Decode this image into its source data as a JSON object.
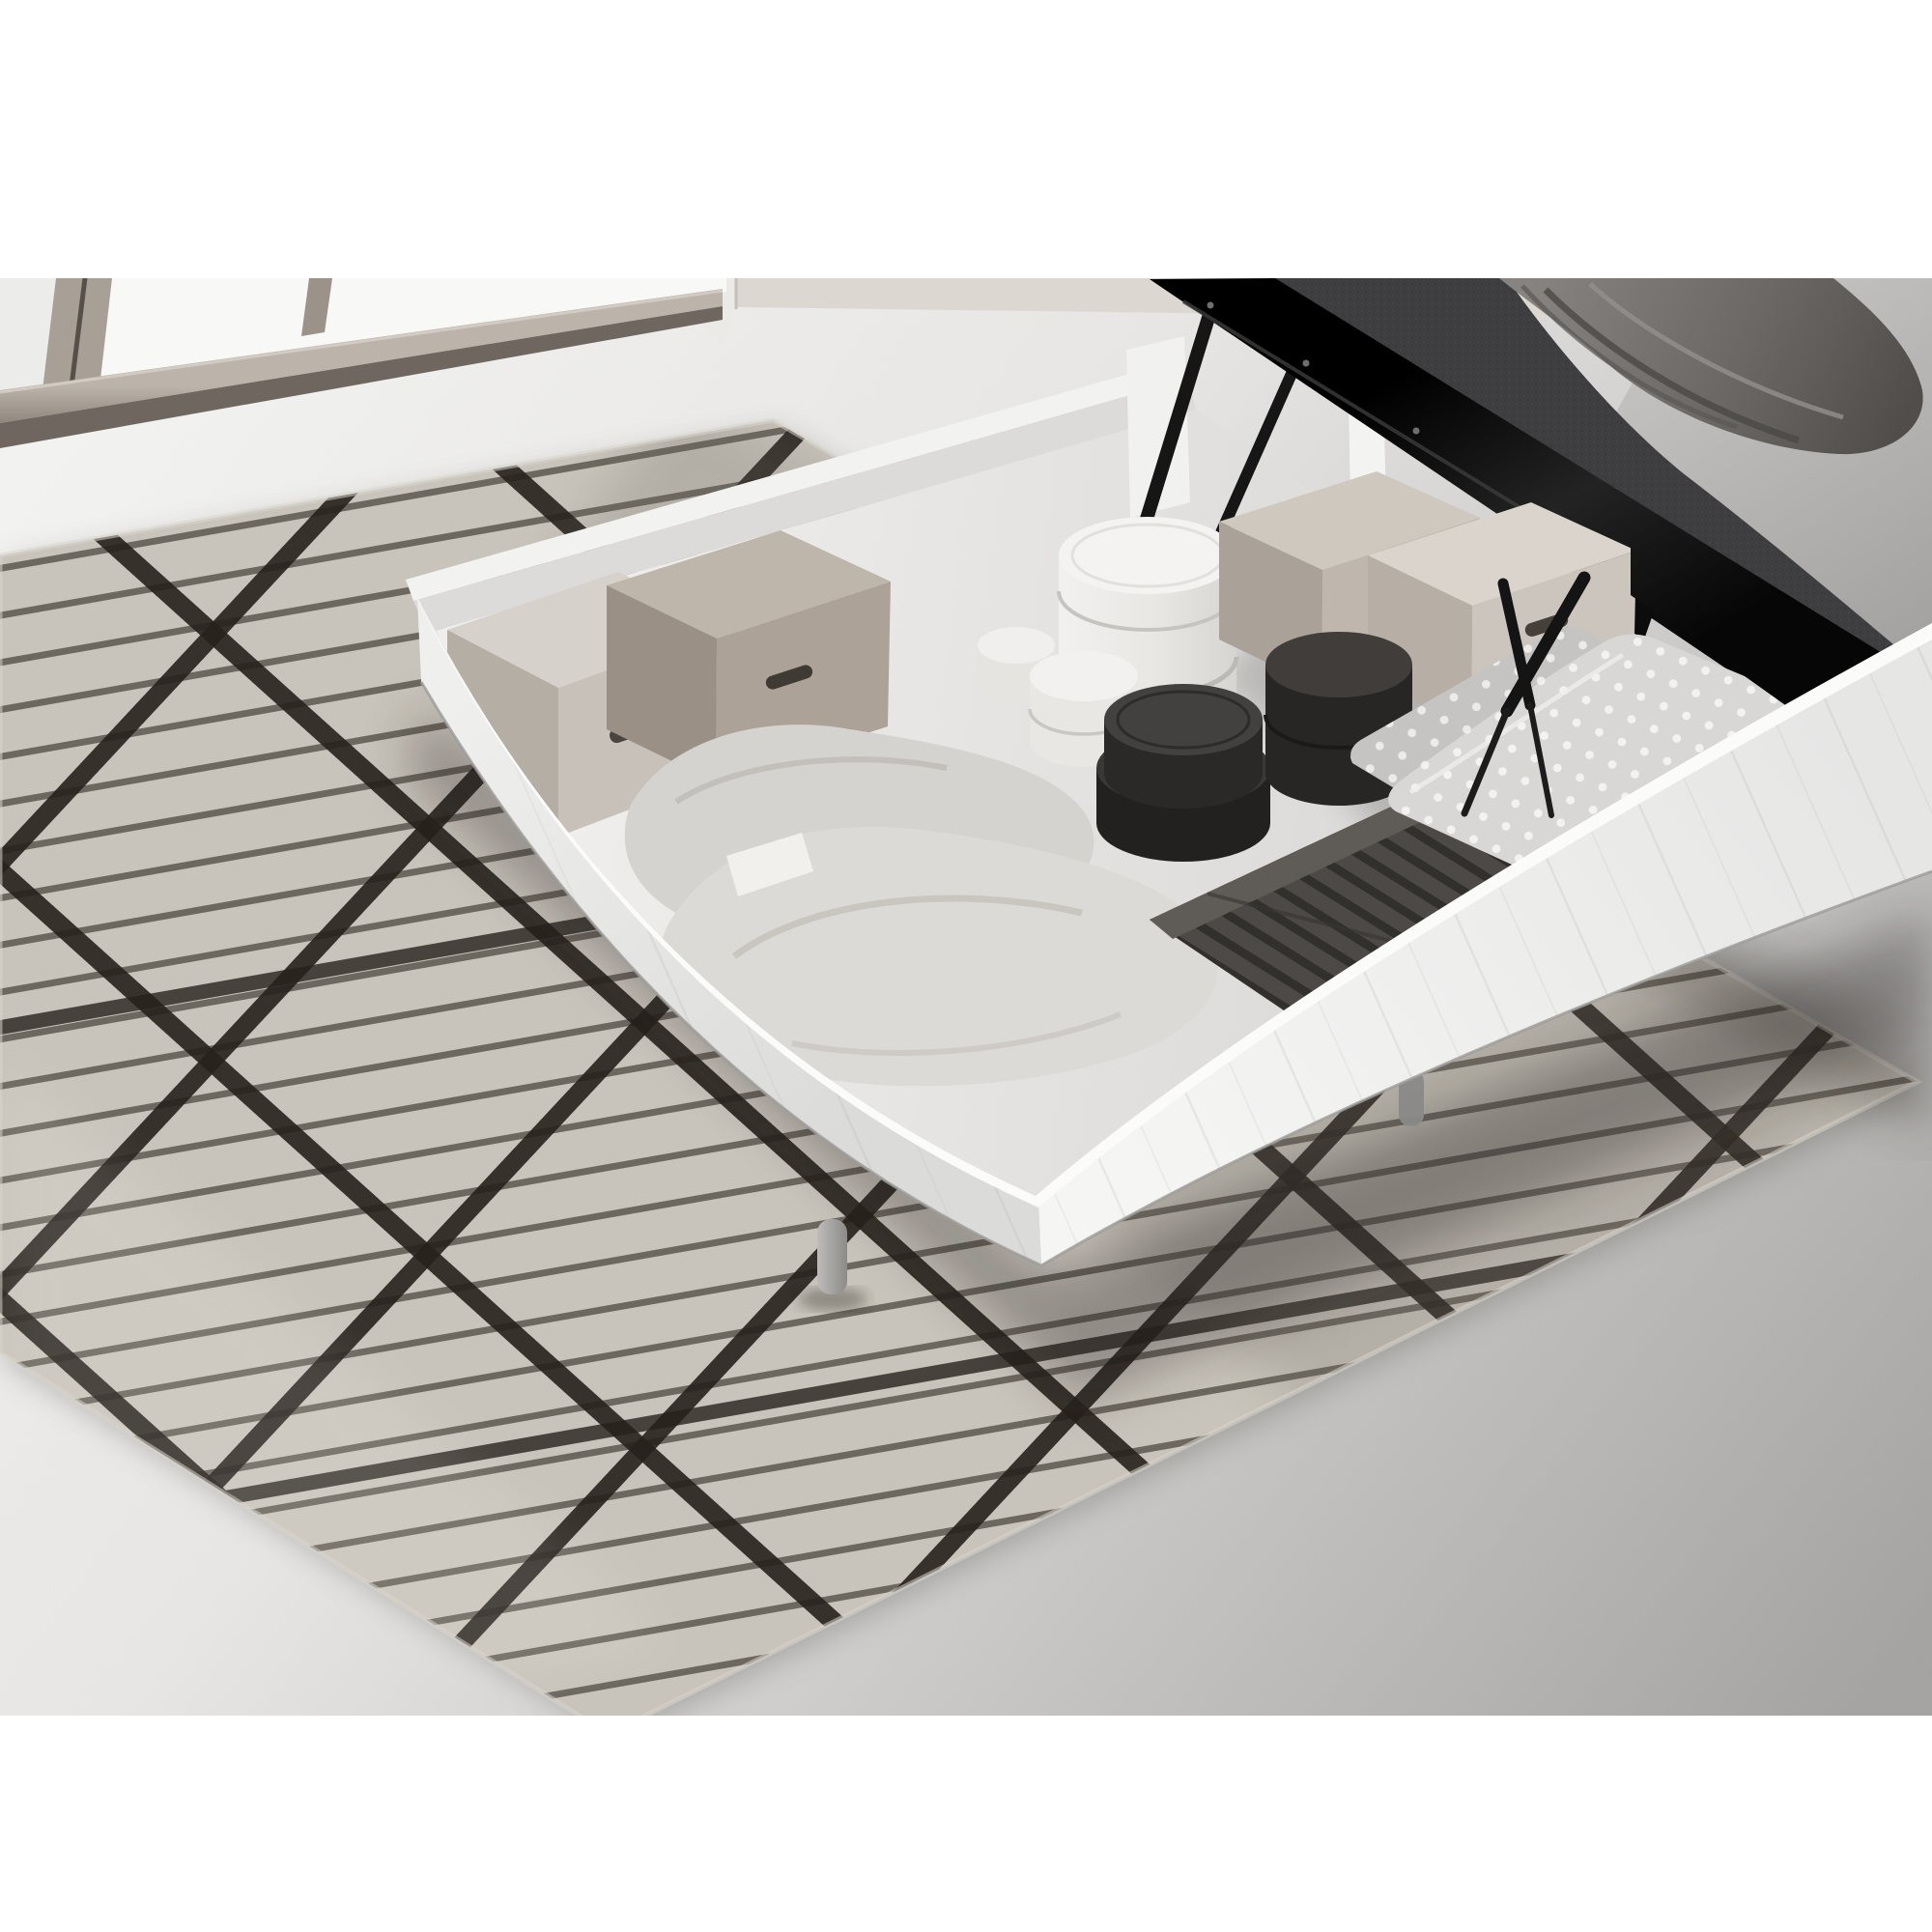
{
  "meta": {
    "description": "Product photo of a white ottoman storage bed with the mattress platform lifted open on black gas struts, revealing under-bed storage filled with cartons, hat boxes, pillows and a knit blanket; the bed stands on a geometric black-line rug over a concrete floor beside full-height windows.",
    "image_type": "product-photo",
    "text_content_visible": "none"
  },
  "palette": {
    "page_bg": "#ffffff",
    "floor_light": "#f4f4f3",
    "floor_mid": "#d9d8d6",
    "floor_dark": "#a8a6a4",
    "wall": "#dcd7d1",
    "wall_beige": "#d8d3cd",
    "glass": "#f8f8f7",
    "frame_metal": "#a89f96",
    "frame_metal_dark": "#6e665f",
    "rug_base": "#c9c4bb",
    "rug_line": "#28231d",
    "box_white": "#f1f1f0",
    "box_shade": "#e2e1e0",
    "box_interior": "#eae9e7",
    "carton_light": "#d3cdc5",
    "carton_taupe": "#aca297",
    "hatbox_white": "#f3f2f0",
    "hatbox_dark": "#2c2a28",
    "blanket_knit": "#4c4946",
    "pillow_gray": "#d9d7d3",
    "polka_base": "#d7d6d4",
    "mattress_black": "#121212",
    "mattress_woven": "#3e3d3f",
    "duvet_velvet": "#6f6c69",
    "mattress_side": "#b9b7b5",
    "headboard": "#ecebe9",
    "strut_black": "#141414",
    "leg_gray": "#a7a6a4"
  },
  "scene": {
    "room": {
      "window": "full-height glazing, champagne metal frame",
      "floor": "pale concrete"
    },
    "bed": {
      "type": "ottoman storage bed",
      "base_color_name": "white woodgrain",
      "lift": "dual black gas-piston struts",
      "mattress": "charcoal woven top with gray velvet throw"
    },
    "storage_items": [
      {
        "label": "greige carton with handle",
        "count": 2
      },
      {
        "label": "taupe carton with handle",
        "count": 2
      },
      {
        "label": "white round hat boxes stacked",
        "count": 2
      },
      {
        "label": "black round hat boxes",
        "count": 3
      },
      {
        "label": "soft gray pillows",
        "count": 2
      },
      {
        "label": "white polka-dot pillows",
        "count": 2
      },
      {
        "label": "dark gray ribbed knit blanket folded",
        "count": 1
      }
    ],
    "rug": {
      "style": "greige pile with black pinstripes and bold triangular lattice"
    }
  }
}
